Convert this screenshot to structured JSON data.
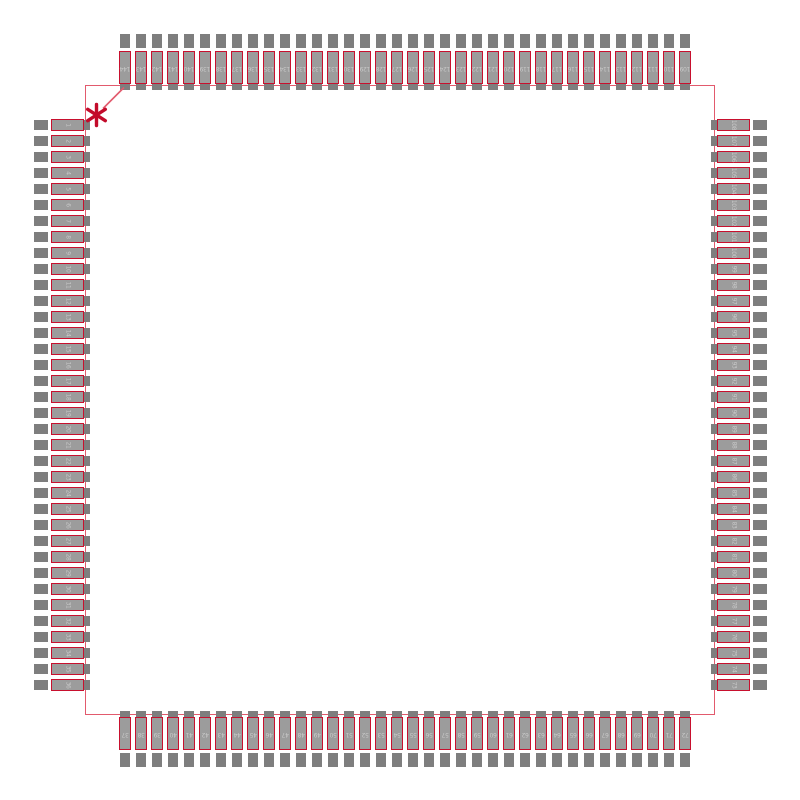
{
  "figure": {
    "kind": "ic-package-footprint-preview",
    "pin_count": 144,
    "pins_per_side": 36,
    "pin1_marker_glyph": "*"
  },
  "colors": {
    "red": "#c8102e",
    "body": "#e25a6d",
    "pad": "#7e7e7e",
    "fill": "#9c9c9c",
    "txt": "#c9c9c9",
    "mark": "#c30b2b",
    "bg": "#ffffff"
  },
  "sides": {
    "left": {
      "order": "top-to-bottom",
      "pins": [
        "1",
        "2",
        "3",
        "4",
        "5",
        "6",
        "7",
        "8",
        "9",
        "10",
        "11",
        "12",
        "13",
        "14",
        "15",
        "16",
        "17",
        "18",
        "19",
        "20",
        "21",
        "22",
        "23",
        "24",
        "25",
        "26",
        "27",
        "28",
        "29",
        "30",
        "31",
        "32",
        "33",
        "34",
        "35",
        "36"
      ]
    },
    "bottom": {
      "order": "left-to-right",
      "pins": [
        "37",
        "38",
        "39",
        "40",
        "41",
        "42",
        "43",
        "44",
        "45",
        "46",
        "47",
        "48",
        "49",
        "50",
        "51",
        "52",
        "53",
        "54",
        "55",
        "56",
        "57",
        "58",
        "59",
        "60",
        "61",
        "62",
        "63",
        "64",
        "65",
        "66",
        "67",
        "68",
        "69",
        "70",
        "71",
        "72"
      ]
    },
    "right": {
      "order": "top-to-bottom",
      "pins": [
        "108",
        "107",
        "106",
        "105",
        "104",
        "103",
        "102",
        "101",
        "100",
        "99",
        "98",
        "97",
        "96",
        "95",
        "94",
        "93",
        "92",
        "91",
        "90",
        "89",
        "88",
        "87",
        "86",
        "85",
        "84",
        "83",
        "82",
        "81",
        "80",
        "79",
        "78",
        "77",
        "76",
        "75",
        "74",
        "73"
      ]
    },
    "top": {
      "order": "left-to-right",
      "pins": [
        "144",
        "143",
        "142",
        "141",
        "140",
        "139",
        "138",
        "137",
        "136",
        "135",
        "134",
        "133",
        "132",
        "131",
        "130",
        "129",
        "128",
        "127",
        "126",
        "125",
        "124",
        "123",
        "122",
        "121",
        "120",
        "119",
        "118",
        "117",
        "116",
        "115",
        "114",
        "113",
        "112",
        "111",
        "110",
        "109"
      ]
    }
  }
}
